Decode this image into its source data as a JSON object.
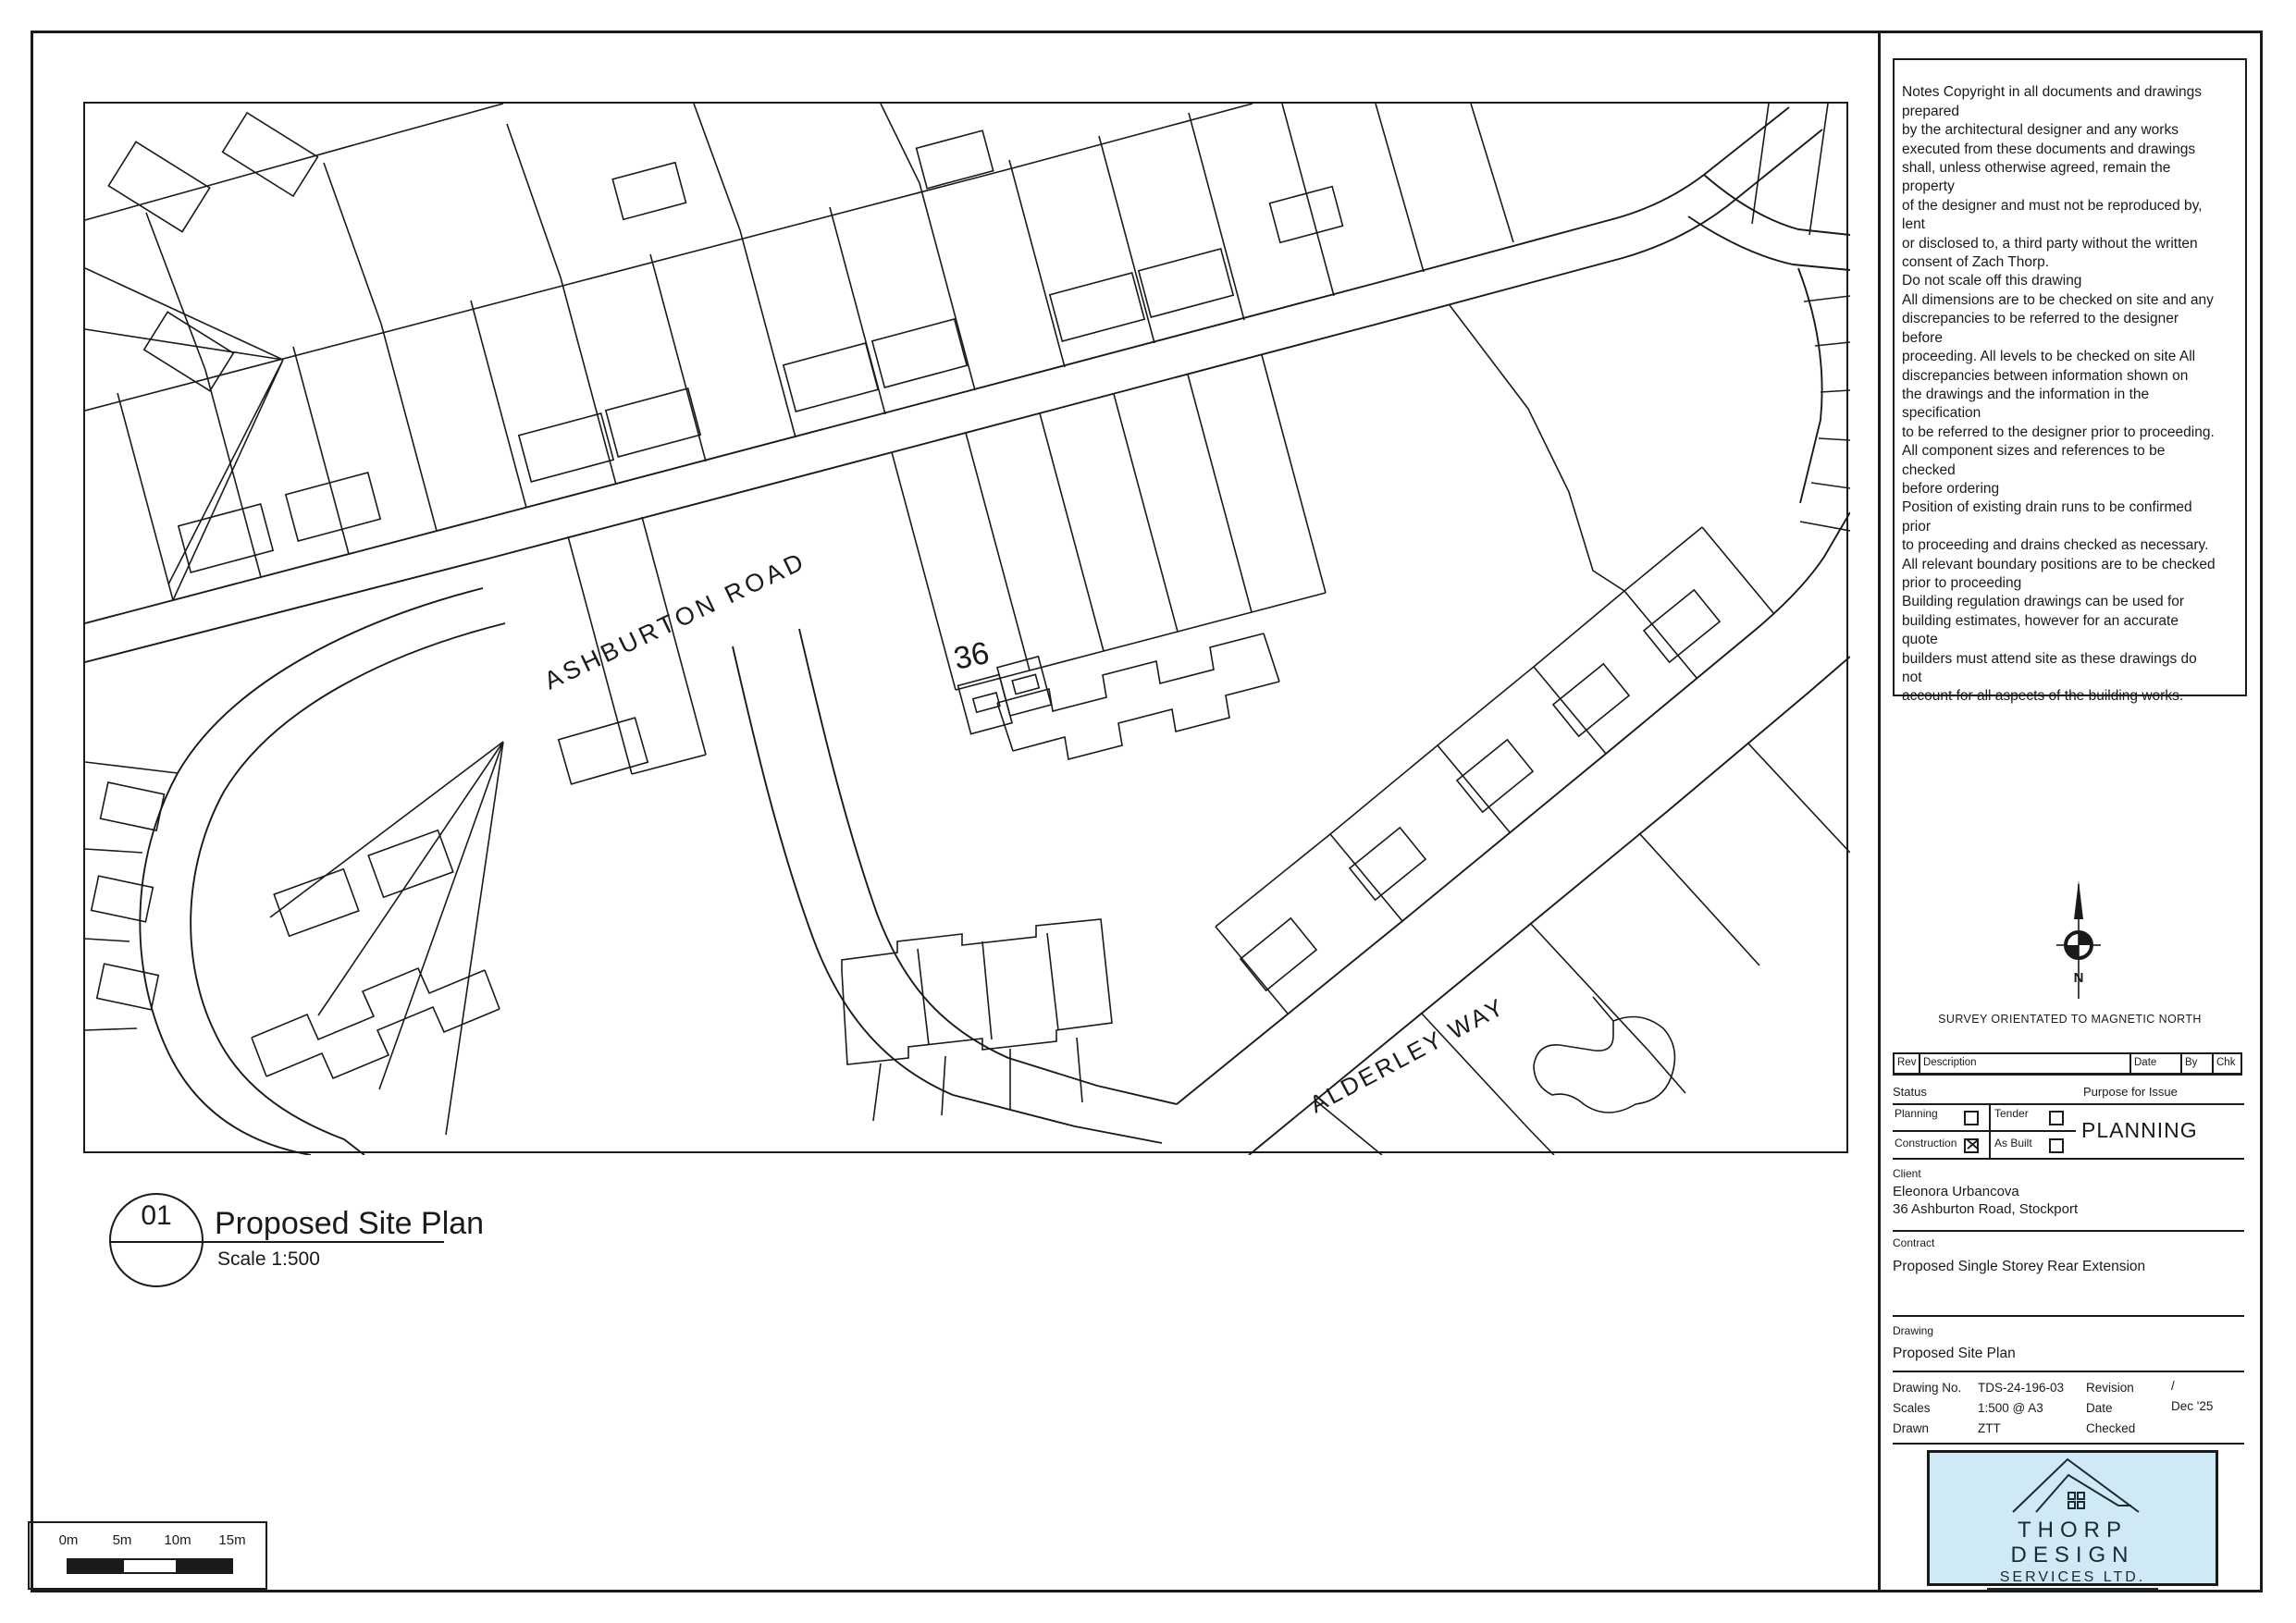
{
  "sheet": {
    "callout_number": "01",
    "title": "Proposed Site Plan",
    "scale_text": "Scale 1:500"
  },
  "plan": {
    "road_ashburton": "ASHBURTON ROAD",
    "road_alderley": "ALDERLEY WAY",
    "house_number": "36"
  },
  "scalebar": {
    "l0": "0m",
    "l1": "5m",
    "l2": "10m",
    "l3": "15m"
  },
  "notes": {
    "body": "Notes Copyright in all documents and drawings\nprepared\nby the architectural designer and any works\nexecuted from these documents and drawings\nshall, unless otherwise agreed, remain the\nproperty\nof the designer and must not be reproduced by,\nlent\nor disclosed to, a third party without the written\nconsent of Zach Thorp.\nDo not scale off this drawing\nAll dimensions are to be checked on site and any\ndiscrepancies to be referred to the designer\nbefore\nproceeding. All levels to be checked on site All\ndiscrepancies between information shown on\nthe drawings and the information in the\nspecification\nto be referred to the designer prior to proceeding.\nAll component sizes and references to be\nchecked\nbefore ordering\nPosition of existing drain runs to be confirmed\nprior\nto proceeding and drains checked as necessary.\nAll relevant boundary positions are to be checked\nprior to proceeding\nBuilding regulation drawings can be used for\nbuilding estimates, however for an accurate\nquote\nbuilders must attend site as these drawings do\nnot\naccount for all aspects of the building works."
  },
  "north": {
    "n": "N",
    "caption": "SURVEY ORIENTATED TO MAGNETIC NORTH"
  },
  "revtable": {
    "rev": "Rev",
    "description": "Description",
    "date": "Date",
    "by": "By",
    "chk": "Chk"
  },
  "status": {
    "heading": "Status",
    "purpose_heading": "Purpose for Issue",
    "purpose_value": "PLANNING",
    "options": [
      {
        "label": "Planning",
        "mark": ""
      },
      {
        "label": "Tender",
        "mark": ""
      },
      {
        "label": "Construction",
        "mark": "✕"
      },
      {
        "label": "As Built",
        "mark": ""
      }
    ]
  },
  "client": {
    "heading": "Client",
    "name": "Eleonora Urbancova",
    "address": "36 Ashburton Road, Stockport"
  },
  "contract": {
    "heading": "Contract",
    "value": "Proposed Single Storey Rear Extension"
  },
  "drawing": {
    "heading": "Drawing",
    "value": "Proposed Site Plan"
  },
  "issue": {
    "drawing_no_label": "Drawing No.",
    "drawing_no": "TDS-24-196-03",
    "scales_label": "Scales",
    "scales": "1:500 @ A3",
    "drawn_label": "Drawn",
    "drawn": "ZTT",
    "revision_label": "Revision",
    "revision": "/",
    "date_label": "Date",
    "date": "Dec '25",
    "checked_label": "Checked",
    "checked": ""
  },
  "logo": {
    "name1": "THORP",
    "name2": "DESIGN",
    "name3": "SERVICES LTD."
  },
  "colors": {
    "ink": "#1a1a1a",
    "logo_bg": "#cfe9f5"
  }
}
